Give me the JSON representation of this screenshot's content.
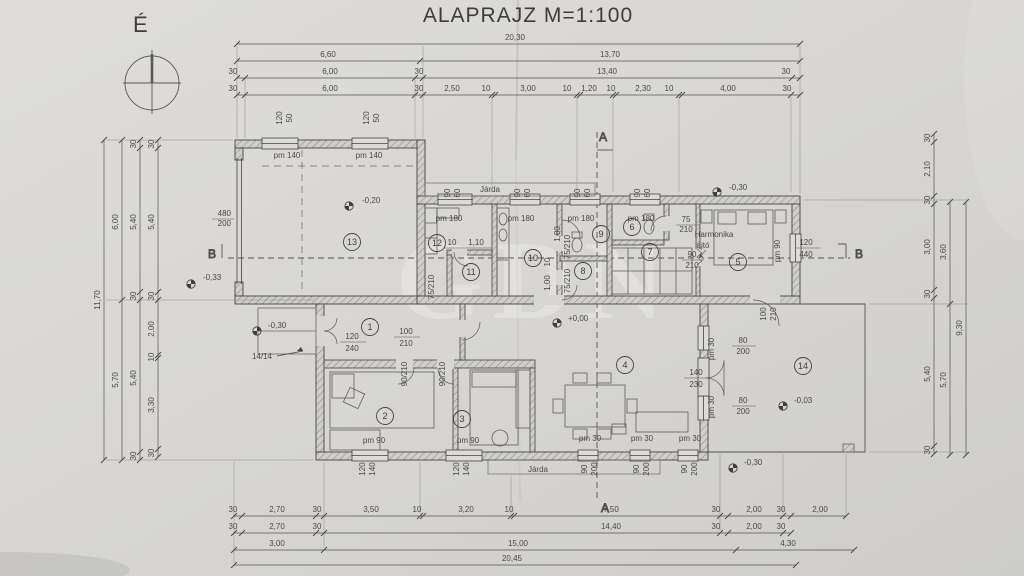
{
  "title": "ALAPRAJZ M=1:100",
  "compass": {
    "label": "É"
  },
  "watermark": {
    "text": "GDN"
  },
  "sections": {
    "a_top": "A",
    "a_bottom": "A",
    "b_left": "B",
    "b_right": "B"
  },
  "rooms": [
    "1",
    "2",
    "3",
    "4",
    "5",
    "6",
    "7",
    "8",
    "9",
    "10",
    "11",
    "12",
    "13",
    "14"
  ],
  "colors": {
    "ink": "#4b4a47",
    "paper": "#d7d6d2"
  },
  "dims": {
    "top": [
      {
        "t": "20,30",
        "x": 515,
        "y": 40
      },
      {
        "t": "6,60",
        "x": 328,
        "y": 57
      },
      {
        "t": "13,70",
        "x": 610,
        "y": 57
      },
      {
        "t": "30",
        "x": 233,
        "y": 74
      },
      {
        "t": "6,00",
        "x": 330,
        "y": 74
      },
      {
        "t": "30",
        "x": 419,
        "y": 74
      },
      {
        "t": "13,40",
        "x": 607,
        "y": 74
      },
      {
        "t": "30",
        "x": 786,
        "y": 74
      },
      {
        "t": "30",
        "x": 233,
        "y": 91
      },
      {
        "t": "6,00",
        "x": 330,
        "y": 91
      },
      {
        "t": "30",
        "x": 419,
        "y": 91
      },
      {
        "t": "2,50",
        "x": 452,
        "y": 91
      },
      {
        "t": "10",
        "x": 486,
        "y": 91
      },
      {
        "t": "3,00",
        "x": 528,
        "y": 91
      },
      {
        "t": "10",
        "x": 567,
        "y": 91
      },
      {
        "t": "1,20",
        "x": 589,
        "y": 91
      },
      {
        "t": "10",
        "x": 611,
        "y": 91
      },
      {
        "t": "2,30",
        "x": 643,
        "y": 91
      },
      {
        "t": "10",
        "x": 669,
        "y": 91
      },
      {
        "t": "4,00",
        "x": 728,
        "y": 91
      },
      {
        "t": "30",
        "x": 787,
        "y": 91
      }
    ],
    "bottom": [
      {
        "t": "30",
        "x": 233,
        "y": 512
      },
      {
        "t": "2,70",
        "x": 277,
        "y": 512
      },
      {
        "t": "30",
        "x": 317,
        "y": 512
      },
      {
        "t": "3,50",
        "x": 371,
        "y": 512
      },
      {
        "t": "10",
        "x": 417,
        "y": 512
      },
      {
        "t": "3,20",
        "x": 466,
        "y": 512
      },
      {
        "t": "10",
        "x": 509,
        "y": 512
      },
      {
        "t": "7,50",
        "x": 611,
        "y": 512
      },
      {
        "t": "30",
        "x": 716,
        "y": 512
      },
      {
        "t": "2,00",
        "x": 754,
        "y": 512
      },
      {
        "t": "30",
        "x": 781,
        "y": 512
      },
      {
        "t": "2,00",
        "x": 820,
        "y": 512
      },
      {
        "t": "30",
        "x": 233,
        "y": 529
      },
      {
        "t": "2,70",
        "x": 277,
        "y": 529
      },
      {
        "t": "30",
        "x": 317,
        "y": 529
      },
      {
        "t": "14,40",
        "x": 611,
        "y": 529
      },
      {
        "t": "30",
        "x": 716,
        "y": 529
      },
      {
        "t": "2,00",
        "x": 754,
        "y": 529
      },
      {
        "t": "30",
        "x": 781,
        "y": 529
      },
      {
        "t": "3,00",
        "x": 277,
        "y": 546
      },
      {
        "t": "15,00",
        "x": 518,
        "y": 546
      },
      {
        "t": "4,30",
        "x": 788,
        "y": 546
      },
      {
        "t": "20,45",
        "x": 512,
        "y": 561
      }
    ],
    "left": [
      {
        "t": "11,70",
        "x": 100,
        "y": 300,
        "r": -90
      },
      {
        "t": "6,00",
        "x": 118,
        "y": 222,
        "r": -90
      },
      {
        "t": "5,70",
        "x": 118,
        "y": 380,
        "r": -90
      },
      {
        "t": "30",
        "x": 136,
        "y": 144,
        "r": -90
      },
      {
        "t": "5,40",
        "x": 136,
        "y": 222,
        "r": -90
      },
      {
        "t": "30",
        "x": 136,
        "y": 296,
        "r": -90
      },
      {
        "t": "5,40",
        "x": 136,
        "y": 378,
        "r": -90
      },
      {
        "t": "30",
        "x": 136,
        "y": 456,
        "r": -90
      },
      {
        "t": "30",
        "x": 154,
        "y": 144,
        "r": -90
      },
      {
        "t": "5,40",
        "x": 154,
        "y": 222,
        "r": -90
      },
      {
        "t": "30",
        "x": 154,
        "y": 296,
        "r": -90
      },
      {
        "t": "2,00",
        "x": 154,
        "y": 329,
        "r": -90
      },
      {
        "t": "10",
        "x": 154,
        "y": 357,
        "r": -90
      },
      {
        "t": "3,30",
        "x": 154,
        "y": 405,
        "r": -90
      },
      {
        "t": "30",
        "x": 154,
        "y": 453,
        "r": -90
      }
    ],
    "right": [
      {
        "t": "30",
        "x": 930,
        "y": 138,
        "r": -90
      },
      {
        "t": "2,10",
        "x": 930,
        "y": 169,
        "r": -90
      },
      {
        "t": "30",
        "x": 930,
        "y": 200,
        "r": -90
      },
      {
        "t": "3,00",
        "x": 930,
        "y": 247,
        "r": -90
      },
      {
        "t": "30",
        "x": 930,
        "y": 294,
        "r": -90
      },
      {
        "t": "5,40",
        "x": 930,
        "y": 374,
        "r": -90
      },
      {
        "t": "30",
        "x": 930,
        "y": 450,
        "r": -90
      },
      {
        "t": "3,60",
        "x": 946,
        "y": 252,
        "r": -90
      },
      {
        "t": "5,70",
        "x": 946,
        "y": 380,
        "r": -90
      },
      {
        "t": "9,30",
        "x": 962,
        "y": 328,
        "r": -90
      }
    ]
  },
  "annotations": [
    {
      "t": "Járda",
      "x": 490,
      "y": 192,
      "fs": 10
    },
    {
      "t": "Járda",
      "x": 538,
      "y": 472,
      "fs": 10
    },
    {
      "t": "pm 140",
      "x": 287,
      "y": 158
    },
    {
      "t": "pm 140",
      "x": 369,
      "y": 158
    },
    {
      "t": "120",
      "x": 282,
      "y": 118,
      "r": -90,
      "fs": 7
    },
    {
      "t": "50",
      "x": 292,
      "y": 118,
      "r": -90,
      "fs": 7
    },
    {
      "t": "120",
      "x": 369,
      "y": 118,
      "r": -90,
      "fs": 7
    },
    {
      "t": "50",
      "x": 379,
      "y": 118,
      "r": -90,
      "fs": 7
    },
    {
      "t": "480",
      "x": 231,
      "y": 216,
      "a": "end"
    },
    {
      "t": "200",
      "x": 231,
      "y": 226,
      "a": "end"
    },
    {
      "t": "-0,20",
      "x": 362,
      "y": 203,
      "a": "start"
    },
    {
      "t": "-0,33",
      "x": 203,
      "y": 280,
      "a": "start"
    },
    {
      "t": "-0,30",
      "x": 729,
      "y": 190,
      "a": "start"
    },
    {
      "t": "-0,30",
      "x": 268,
      "y": 328,
      "a": "start"
    },
    {
      "t": "+0,00",
      "x": 568,
      "y": 321,
      "a": "start"
    },
    {
      "t": "-0,03",
      "x": 794,
      "y": 403,
      "a": "start"
    },
    {
      "t": "-0,30",
      "x": 744,
      "y": 465,
      "a": "start"
    },
    {
      "t": "14/14",
      "x": 262,
      "y": 359
    },
    {
      "t": "pm 180",
      "x": 449,
      "y": 221
    },
    {
      "t": "pm 180",
      "x": 521,
      "y": 221
    },
    {
      "t": "pm 180",
      "x": 581,
      "y": 221
    },
    {
      "t": "pm 180",
      "x": 641,
      "y": 221
    },
    {
      "t": "90",
      "x": 450,
      "y": 193,
      "r": -90,
      "fs": 7
    },
    {
      "t": "60",
      "x": 460,
      "y": 193,
      "r": -90,
      "fs": 7
    },
    {
      "t": "90",
      "x": 520,
      "y": 193,
      "r": -90,
      "fs": 7
    },
    {
      "t": "60",
      "x": 530,
      "y": 193,
      "r": -90,
      "fs": 7
    },
    {
      "t": "90",
      "x": 580,
      "y": 193,
      "r": -90,
      "fs": 7
    },
    {
      "t": "60",
      "x": 590,
      "y": 193,
      "r": -90,
      "fs": 7
    },
    {
      "t": "90",
      "x": 640,
      "y": 193,
      "r": -90,
      "fs": 7
    },
    {
      "t": "60",
      "x": 650,
      "y": 193,
      "r": -90,
      "fs": 7
    },
    {
      "t": "10",
      "x": 452,
      "y": 245,
      "fs": 7
    },
    {
      "t": "1,10",
      "x": 476,
      "y": 245,
      "fs": 7
    },
    {
      "t": "1,80",
      "x": 560,
      "y": 234,
      "r": -90,
      "fs": 7
    },
    {
      "t": "10",
      "x": 550,
      "y": 262,
      "r": -90,
      "fs": 7
    },
    {
      "t": "1,00",
      "x": 550,
      "y": 283,
      "r": -90,
      "fs": 7
    },
    {
      "t": "75/210",
      "x": 434,
      "y": 287,
      "r": -90,
      "fs": 7
    },
    {
      "t": "75/210",
      "x": 570,
      "y": 247,
      "r": -90,
      "fs": 7
    },
    {
      "t": "75/210",
      "x": 570,
      "y": 281,
      "r": -90,
      "fs": 7
    },
    {
      "t": "75",
      "x": 686,
      "y": 222
    },
    {
      "t": "210",
      "x": 686,
      "y": 232
    },
    {
      "t": "Harmonika",
      "x": 714,
      "y": 237
    },
    {
      "t": "ajtó",
      "x": 703,
      "y": 248
    },
    {
      "t": "90",
      "x": 692,
      "y": 257
    },
    {
      "t": "210",
      "x": 692,
      "y": 268
    },
    {
      "t": "120",
      "x": 806,
      "y": 245
    },
    {
      "t": "440",
      "x": 806,
      "y": 257
    },
    {
      "t": "pm 90",
      "x": 780,
      "y": 251,
      "r": -90,
      "fs": 7
    },
    {
      "t": "120",
      "x": 352,
      "y": 339
    },
    {
      "t": "240",
      "x": 352,
      "y": 351
    },
    {
      "t": "100",
      "x": 406,
      "y": 334
    },
    {
      "t": "210",
      "x": 406,
      "y": 346
    },
    {
      "t": "90/210",
      "x": 407,
      "y": 374,
      "r": -90,
      "fs": 7
    },
    {
      "t": "90/210",
      "x": 445,
      "y": 374,
      "r": -90,
      "fs": 7
    },
    {
      "t": "pm 90",
      "x": 374,
      "y": 443
    },
    {
      "t": "pm 90",
      "x": 468,
      "y": 443
    },
    {
      "t": "120",
      "x": 365,
      "y": 469,
      "r": -90,
      "fs": 7
    },
    {
      "t": "140",
      "x": 375,
      "y": 469,
      "r": -90,
      "fs": 7
    },
    {
      "t": "120",
      "x": 459,
      "y": 469,
      "r": -90,
      "fs": 7
    },
    {
      "t": "140",
      "x": 469,
      "y": 469,
      "r": -90,
      "fs": 7
    },
    {
      "t": "pm 30",
      "x": 590,
      "y": 441
    },
    {
      "t": "pm 30",
      "x": 642,
      "y": 441
    },
    {
      "t": "pm 30",
      "x": 690,
      "y": 441
    },
    {
      "t": "90",
      "x": 587,
      "y": 469,
      "r": -90,
      "fs": 7
    },
    {
      "t": "200",
      "x": 597,
      "y": 469,
      "r": -90,
      "fs": 7
    },
    {
      "t": "90",
      "x": 639,
      "y": 469,
      "r": -90,
      "fs": 7
    },
    {
      "t": "200",
      "x": 649,
      "y": 469,
      "r": -90,
      "fs": 7
    },
    {
      "t": "90",
      "x": 687,
      "y": 469,
      "r": -90,
      "fs": 7
    },
    {
      "t": "200",
      "x": 697,
      "y": 469,
      "r": -90,
      "fs": 7
    },
    {
      "t": "80",
      "x": 743,
      "y": 343
    },
    {
      "t": "200",
      "x": 743,
      "y": 354
    },
    {
      "t": "140",
      "x": 696,
      "y": 375
    },
    {
      "t": "230",
      "x": 696,
      "y": 387
    },
    {
      "t": "80",
      "x": 743,
      "y": 403
    },
    {
      "t": "200",
      "x": 743,
      "y": 414
    },
    {
      "t": "pm 30",
      "x": 714,
      "y": 349,
      "r": -90,
      "fs": 7
    },
    {
      "t": "pm 30",
      "x": 714,
      "y": 407,
      "r": -90,
      "fs": 7
    },
    {
      "t": "100",
      "x": 766,
      "y": 314,
      "r": -90,
      "fs": 7
    },
    {
      "t": "210",
      "x": 776,
      "y": 314,
      "r": -90,
      "fs": 7
    }
  ]
}
